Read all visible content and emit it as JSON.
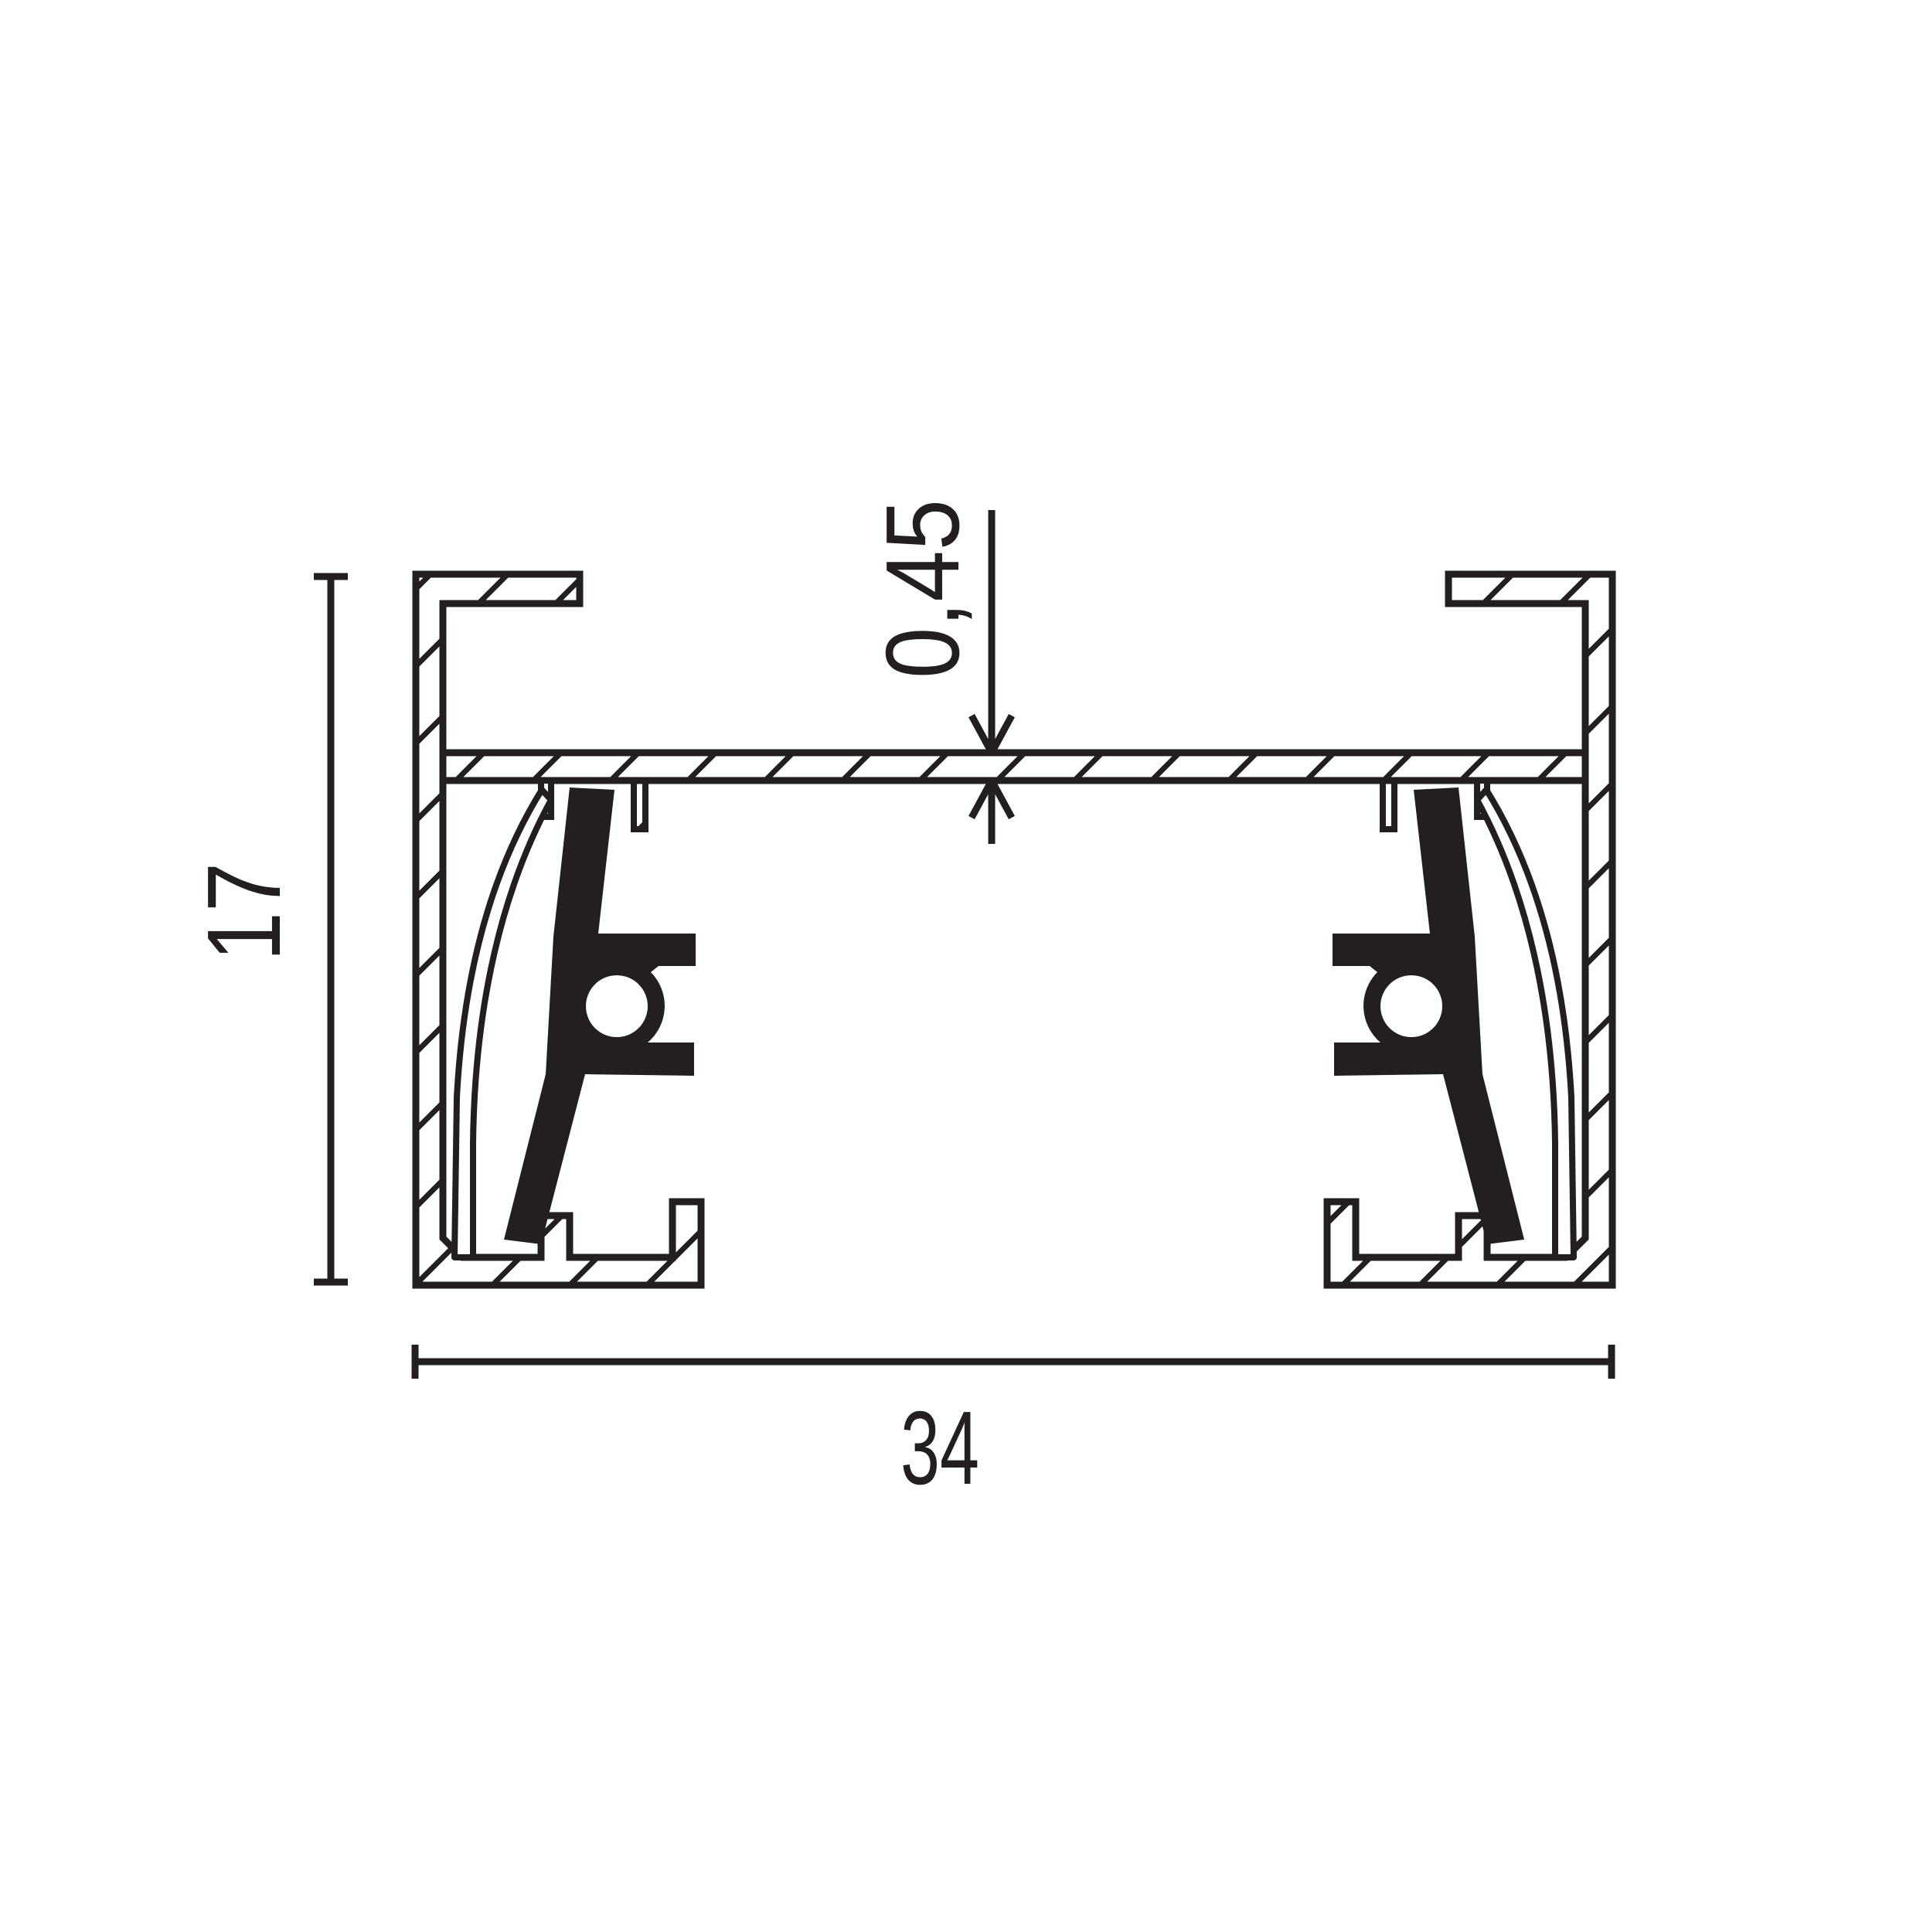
{
  "drawing": {
    "title": "track-profile-cross-section",
    "background_color": "#ffffff",
    "line_color": "#231f20",
    "dimensions": {
      "overall_width_label": "34",
      "overall_height_label": "17",
      "plate_thickness_label": "0,45"
    }
  }
}
